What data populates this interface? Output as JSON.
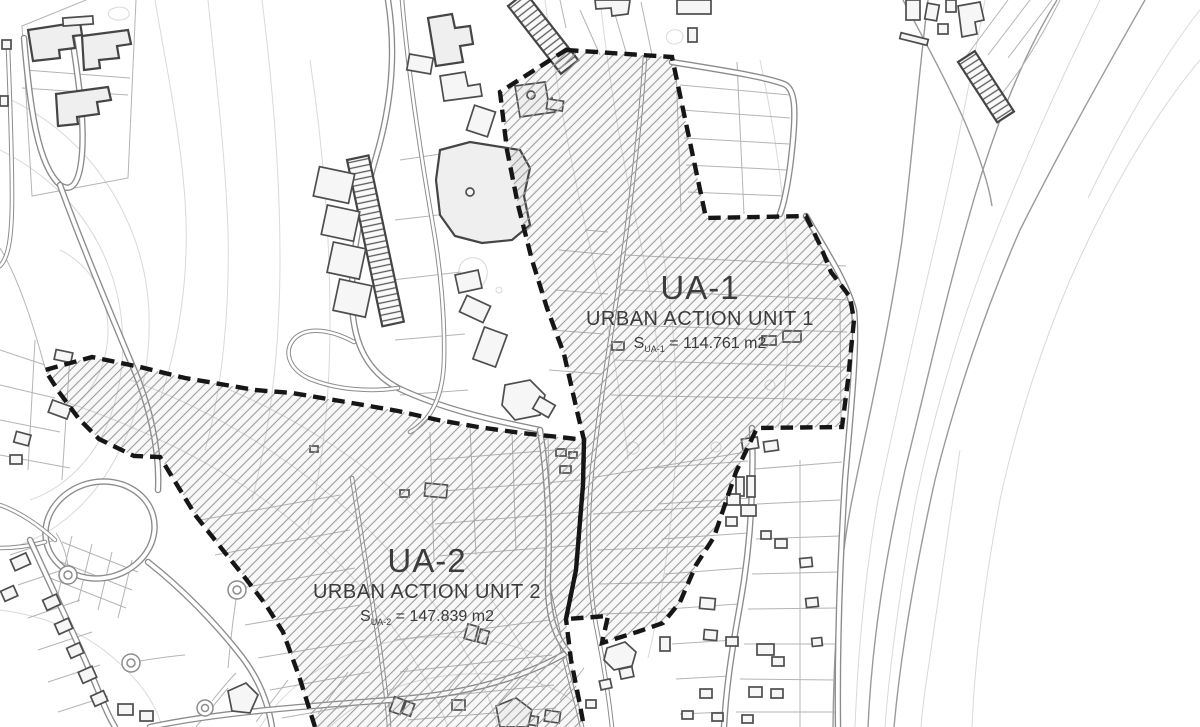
{
  "zones": [
    {
      "code": "UA-1",
      "name": "URBAN ACTION UNIT 1",
      "area_symbol": "S",
      "area_subscript": "UA-1",
      "area_rest": "= 114.761 m2"
    },
    {
      "code": "UA-2",
      "name": "URBAN ACTION UNIT 2",
      "area_symbol": "S",
      "area_subscript": "UA-2",
      "area_rest": "= 147.839 m2"
    }
  ],
  "colors": {
    "background": "#ffffff",
    "boundary": "#161616",
    "hatch": "#9c9c9c",
    "contour": "#d9d9d9",
    "contour_strong": "#9a9a9a",
    "road": "#8c8c8c",
    "parcel": "#b4b4b4",
    "building_stroke": "#4e4e4e",
    "label_text": "#3c3c3c"
  }
}
